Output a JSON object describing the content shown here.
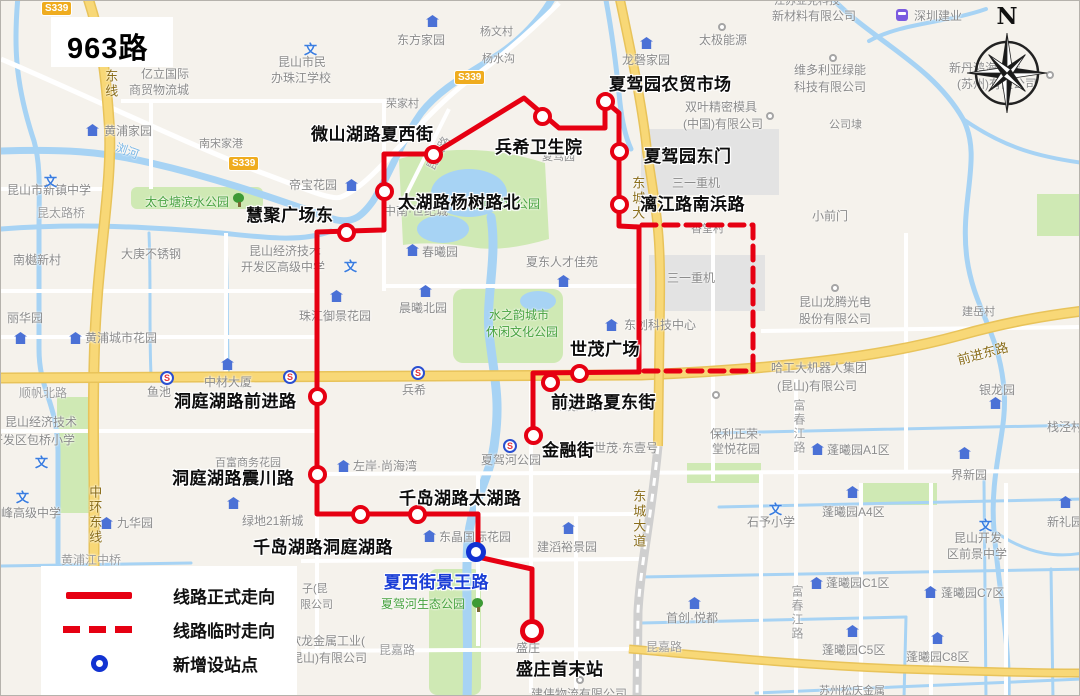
{
  "title": "963路",
  "compass": {
    "north_label": "N"
  },
  "legend": {
    "items": [
      {
        "label": "线路正式走向",
        "symbol": "solid-red-line"
      },
      {
        "label": "线路临时走向",
        "symbol": "dashed-red-line"
      },
      {
        "label": "新增设站点",
        "symbol": "blue-circle"
      }
    ]
  },
  "route": {
    "color": "#e60012",
    "new_station_color": "#1233d2",
    "stations": [
      {
        "n": "夏驾园农贸市场",
        "x": 604,
        "y": 100,
        "lx": 608,
        "ly": 69
      },
      {
        "n": "兵希卫生院",
        "x": 541,
        "y": 115,
        "lx": 494,
        "ly": 132
      },
      {
        "n": "微山湖路夏西街",
        "x": 432,
        "y": 153,
        "lx": 310,
        "ly": 119
      },
      {
        "n": "夏驾园东门",
        "x": 618,
        "y": 150,
        "lx": 643,
        "ly": 141
      },
      {
        "n": "漓江路南浜路",
        "x": 618,
        "y": 203,
        "lx": 639,
        "ly": 189
      },
      {
        "n": "太湖路杨树路北",
        "x": 383,
        "y": 190,
        "lx": 397,
        "ly": 187
      },
      {
        "n": "慧聚广场东",
        "x": 345,
        "y": 231,
        "lx": 245,
        "ly": 200
      },
      {
        "n": "世茂广场",
        "x": 578,
        "y": 372,
        "lx": 569,
        "ly": 334
      },
      {
        "n": "前进路夏东街",
        "x": 549,
        "y": 381,
        "lx": 550,
        "ly": 387
      },
      {
        "n": "金融街",
        "x": 532,
        "y": 434,
        "lx": 541,
        "ly": 435
      },
      {
        "n": "洞庭湖路前进路",
        "x": 316,
        "y": 395,
        "lx": 173,
        "ly": 386
      },
      {
        "n": "洞庭湖路震川路",
        "x": 316,
        "y": 473,
        "lx": 171,
        "ly": 463
      },
      {
        "n": "千岛湖路洞庭湖路",
        "x": 359,
        "y": 513,
        "lx": 252,
        "ly": 532
      },
      {
        "n": "千岛湖路太湖路",
        "x": 416,
        "y": 513,
        "lx": 398,
        "ly": 483
      },
      {
        "n": "夏西街景王路",
        "x": 475,
        "y": 551,
        "lx": 383,
        "ly": 567,
        "type": "blue"
      },
      {
        "n": "盛庄首末站",
        "x": 531,
        "y": 630,
        "lx": 515,
        "ly": 654,
        "type": "terminal"
      }
    ]
  },
  "road_badges": [
    {
      "t": "S339",
      "x": 40,
      "y": 0
    },
    {
      "t": "S339",
      "x": 227,
      "y": 155
    },
    {
      "t": "S339",
      "x": 453,
      "y": 69
    }
  ],
  "map_labels": [
    {
      "t": "昆山市新镇中学",
      "x": 6,
      "y": 182
    },
    {
      "t": "昆太路桥",
      "x": 36,
      "y": 205,
      "c": "road"
    },
    {
      "t": "南樾新村",
      "x": 12,
      "y": 252
    },
    {
      "t": "丽华园",
      "x": 6,
      "y": 310
    },
    {
      "t": "黄浦城市花园",
      "x": 84,
      "y": 330
    },
    {
      "t": "亿立国际",
      "x": 140,
      "y": 66
    },
    {
      "t": "商贸物流城",
      "x": 128,
      "y": 82
    },
    {
      "t": "昆山市民",
      "x": 277,
      "y": 54
    },
    {
      "t": "办珠江学校",
      "x": 270,
      "y": 70
    },
    {
      "t": "黄浦家园",
      "x": 103,
      "y": 123
    },
    {
      "t": "南宋家港",
      "x": 198,
      "y": 137,
      "c": "g11"
    },
    {
      "t": "大庚不锈钢",
      "x": 120,
      "y": 246
    },
    {
      "t": "昆山经济技术",
      "x": 248,
      "y": 243
    },
    {
      "t": "开发区高级中学",
      "x": 240,
      "y": 259
    },
    {
      "t": "帝宝花园",
      "x": 288,
      "y": 177
    },
    {
      "t": "珠江御景花园",
      "x": 298,
      "y": 308
    },
    {
      "t": "中材大厦",
      "x": 203,
      "y": 374
    },
    {
      "t": "鱼池",
      "x": 146,
      "y": 384
    },
    {
      "t": "顺帆北路",
      "x": 18,
      "y": 385,
      "c": "road"
    },
    {
      "t": "昆山经济技术",
      "x": 4,
      "y": 414
    },
    {
      "t": "开发区包桥小学",
      "x": -10,
      "y": 432
    },
    {
      "t": "峰高级中学",
      "x": 0,
      "y": 505
    },
    {
      "t": "黄浦江中桥",
      "x": 60,
      "y": 552,
      "c": "road"
    },
    {
      "t": "九华园",
      "x": 116,
      "y": 515
    },
    {
      "t": "绿地21新城",
      "x": 241,
      "y": 513
    },
    {
      "t": "百富商务花园",
      "x": 214,
      "y": 456,
      "c": "g11"
    },
    {
      "t": "左岸·尚海湾",
      "x": 352,
      "y": 458
    },
    {
      "t": "中南·世纪城",
      "x": 383,
      "y": 203
    },
    {
      "t": "荣家村",
      "x": 385,
      "y": 97,
      "c": "g11"
    },
    {
      "t": "东方家园",
      "x": 396,
      "y": 32
    },
    {
      "t": "杨文村",
      "x": 479,
      "y": 25,
      "c": "g11"
    },
    {
      "t": "杨水沟",
      "x": 481,
      "y": 52,
      "c": "g11"
    },
    {
      "t": "龙磬家园",
      "x": 621,
      "y": 52
    },
    {
      "t": "太极能源",
      "x": 698,
      "y": 32
    },
    {
      "t": "双叶精密模具",
      "x": 684,
      "y": 99
    },
    {
      "t": "(中国)有限公司",
      "x": 682,
      "y": 116
    },
    {
      "t": "夏驾园",
      "x": 541,
      "y": 150,
      "c": "g11"
    },
    {
      "t": "三一重机",
      "x": 671,
      "y": 175
    },
    {
      "t": "三一重机",
      "x": 666,
      "y": 270
    },
    {
      "t": "香堂村",
      "x": 690,
      "y": 222,
      "c": "g11"
    },
    {
      "t": "夏东人才佳苑",
      "x": 525,
      "y": 254
    },
    {
      "t": "春曦园",
      "x": 421,
      "y": 244
    },
    {
      "t": "晨曦北园",
      "x": 398,
      "y": 300
    },
    {
      "t": "东创科技中心",
      "x": 623,
      "y": 317
    },
    {
      "t": "世茂广场",
      "x": 553,
      "y": 400,
      "c": "g11"
    },
    {
      "t": "世茂·东壹号",
      "x": 593,
      "y": 440
    },
    {
      "t": "保利正荣·",
      "x": 709,
      "y": 426
    },
    {
      "t": "堂悦花园",
      "x": 711,
      "y": 441
    },
    {
      "t": "夏驾河公园",
      "x": 480,
      "y": 452
    },
    {
      "t": "兵希",
      "x": 401,
      "y": 382
    },
    {
      "t": "东晶国际花园",
      "x": 438,
      "y": 529
    },
    {
      "t": "建滔裕景园",
      "x": 536,
      "y": 539
    },
    {
      "t": "盛庄",
      "x": 515,
      "y": 640
    },
    {
      "t": "建伟物流有限公司",
      "x": 530,
      "y": 686
    },
    {
      "t": "首创·悦都",
      "x": 665,
      "y": 610
    },
    {
      "t": "昆嘉路",
      "x": 645,
      "y": 639,
      "c": "road"
    },
    {
      "t": "昆嘉路",
      "x": 378,
      "y": 642,
      "c": "road"
    },
    {
      "t": "欣龙金属工业(",
      "x": 288,
      "y": 633
    },
    {
      "t": "昆山)有限公司",
      "x": 290,
      "y": 650
    },
    {
      "t": "子(昆",
      "x": 301,
      "y": 582,
      "c": "g11"
    },
    {
      "t": "限公司",
      "x": 299,
      "y": 598,
      "c": "g11"
    },
    {
      "t": "石予小学",
      "x": 746,
      "y": 514
    },
    {
      "t": "蓬曦园A4区",
      "x": 821,
      "y": 504
    },
    {
      "t": "蓬曦园A1区",
      "x": 826,
      "y": 442
    },
    {
      "t": "蓬曦园C1区",
      "x": 825,
      "y": 575
    },
    {
      "t": "蓬曦园C7区",
      "x": 940,
      "y": 585
    },
    {
      "t": "蓬曦园C5区",
      "x": 821,
      "y": 642
    },
    {
      "t": "蓬曦园C8区",
      "x": 905,
      "y": 649
    },
    {
      "t": "昆山开发",
      "x": 953,
      "y": 530
    },
    {
      "t": "区前景中学",
      "x": 946,
      "y": 546
    },
    {
      "t": "新礼园",
      "x": 1046,
      "y": 514
    },
    {
      "t": "界新园",
      "x": 950,
      "y": 467
    },
    {
      "t": "银龙园",
      "x": 978,
      "y": 382
    },
    {
      "t": "栈泾村",
      "x": 1046,
      "y": 419
    },
    {
      "t": "昆山龙腾光电",
      "x": 798,
      "y": 294
    },
    {
      "t": "股份有限公司",
      "x": 798,
      "y": 311
    },
    {
      "t": "建岳村",
      "x": 961,
      "y": 305,
      "c": "g11"
    },
    {
      "t": "哈工大机器人集团",
      "x": 770,
      "y": 360
    },
    {
      "t": "(昆山)有限公司",
      "x": 776,
      "y": 378
    },
    {
      "t": "小前门",
      "x": 811,
      "y": 208
    },
    {
      "t": "公司埭",
      "x": 828,
      "y": 118,
      "c": "g11"
    },
    {
      "t": "维多利亚绿能",
      "x": 793,
      "y": 62
    },
    {
      "t": "科技有限公司",
      "x": 793,
      "y": 79
    },
    {
      "t": "江苏亚克科技",
      "x": 773,
      "y": -6,
      "c": "g11"
    },
    {
      "t": "新材料有限公司",
      "x": 771,
      "y": 8
    },
    {
      "t": "深圳建业",
      "x": 913,
      "y": 8
    },
    {
      "t": "新丹鸿海发展",
      "x": 948,
      "y": 60
    },
    {
      "t": "(苏州)有限公司",
      "x": 956,
      "y": 76
    },
    {
      "t": "苏州松庆金属",
      "x": 818,
      "y": 684,
      "c": "g11"
    },
    {
      "t": "夏驾河湿地公园",
      "x": 455,
      "y": 196,
      "c": "green"
    },
    {
      "t": "太仓塘滨水公园",
      "x": 144,
      "y": 194,
      "c": "green"
    },
    {
      "t": "水之韵城市",
      "x": 488,
      "y": 307,
      "c": "green"
    },
    {
      "t": "休闲文化公园",
      "x": 485,
      "y": 324,
      "c": "green"
    },
    {
      "t": "夏驾河生态公园",
      "x": 380,
      "y": 596,
      "c": "green"
    },
    {
      "t": "浏河",
      "x": 114,
      "y": 143,
      "c": "water",
      "r": 20
    },
    {
      "t": "昆太路",
      "x": 420,
      "y": 145,
      "c": "road",
      "r": -62
    },
    {
      "t": "东线",
      "x": 101,
      "y": 68,
      "c": "ry",
      "v": 1
    },
    {
      "t": "中环东线",
      "x": 85,
      "y": 484,
      "c": "ry",
      "v": 1
    },
    {
      "t": "东城大道",
      "x": 629,
      "y": 488,
      "c": "ry",
      "v": 1
    },
    {
      "t": "东城大",
      "x": 628,
      "y": 175,
      "c": "ry",
      "v": 1
    },
    {
      "t": "前进东路",
      "x": 956,
      "y": 345,
      "c": "ry",
      "r": -15
    },
    {
      "t": "富春江路",
      "x": 790,
      "y": 398,
      "c": "road",
      "v": 1
    },
    {
      "t": "富春江路",
      "x": 788,
      "y": 584,
      "c": "road",
      "v": 1
    }
  ],
  "icons": [
    {
      "k": "house",
      "x": 92,
      "y": 130
    },
    {
      "k": "house",
      "x": 20,
      "y": 338
    },
    {
      "k": "house",
      "x": 75,
      "y": 338
    },
    {
      "k": "house",
      "x": 432,
      "y": 21
    },
    {
      "k": "house",
      "x": 646,
      "y": 43
    },
    {
      "k": "house",
      "x": 351,
      "y": 185
    },
    {
      "k": "house",
      "x": 336,
      "y": 296
    },
    {
      "k": "house",
      "x": 227,
      "y": 364
    },
    {
      "k": "house",
      "x": 425,
      "y": 291
    },
    {
      "k": "house",
      "x": 412,
      "y": 250
    },
    {
      "k": "house",
      "x": 563,
      "y": 281
    },
    {
      "k": "house",
      "x": 611,
      "y": 325
    },
    {
      "k": "house",
      "x": 106,
      "y": 523
    },
    {
      "k": "house",
      "x": 233,
      "y": 503
    },
    {
      "k": "house",
      "x": 343,
      "y": 466
    },
    {
      "k": "house",
      "x": 429,
      "y": 536
    },
    {
      "k": "house",
      "x": 568,
      "y": 528
    },
    {
      "k": "house",
      "x": 694,
      "y": 603
    },
    {
      "k": "house",
      "x": 817,
      "y": 449
    },
    {
      "k": "house",
      "x": 852,
      "y": 492
    },
    {
      "k": "house",
      "x": 816,
      "y": 583
    },
    {
      "k": "house",
      "x": 930,
      "y": 592
    },
    {
      "k": "house",
      "x": 852,
      "y": 631
    },
    {
      "k": "house",
      "x": 937,
      "y": 638
    },
    {
      "k": "house",
      "x": 964,
      "y": 453
    },
    {
      "k": "house",
      "x": 995,
      "y": 403
    },
    {
      "k": "house",
      "x": 1065,
      "y": 502
    },
    {
      "k": "wen",
      "x": 310,
      "y": 45
    },
    {
      "k": "wen",
      "x": 50,
      "y": 177
    },
    {
      "k": "wen",
      "x": 350,
      "y": 262
    },
    {
      "k": "wen",
      "x": 41,
      "y": 458
    },
    {
      "k": "wen",
      "x": 22,
      "y": 493
    },
    {
      "k": "wen",
      "x": 775,
      "y": 505
    },
    {
      "k": "wen",
      "x": 985,
      "y": 521
    },
    {
      "k": "metro",
      "x": 166,
      "y": 377
    },
    {
      "k": "metro",
      "x": 289,
      "y": 376
    },
    {
      "k": "metro",
      "x": 417,
      "y": 372
    },
    {
      "k": "metro",
      "x": 509,
      "y": 445
    },
    {
      "k": "tree",
      "x": 239,
      "y": 199
    },
    {
      "k": "tree",
      "x": 478,
      "y": 604
    },
    {
      "k": "poi",
      "x": 724,
      "y": 29
    },
    {
      "k": "poi",
      "x": 772,
      "y": 118
    },
    {
      "k": "poi",
      "x": 835,
      "y": 60
    },
    {
      "k": "poi",
      "x": 1052,
      "y": 77
    },
    {
      "k": "poi",
      "x": 837,
      "y": 290
    },
    {
      "k": "poi",
      "x": 582,
      "y": 682
    },
    {
      "k": "poi",
      "x": 718,
      "y": 397
    },
    {
      "k": "shop",
      "x": 902,
      "y": 15
    }
  ],
  "icon_glyphs": {
    "wen": "文",
    "metro": "S"
  }
}
